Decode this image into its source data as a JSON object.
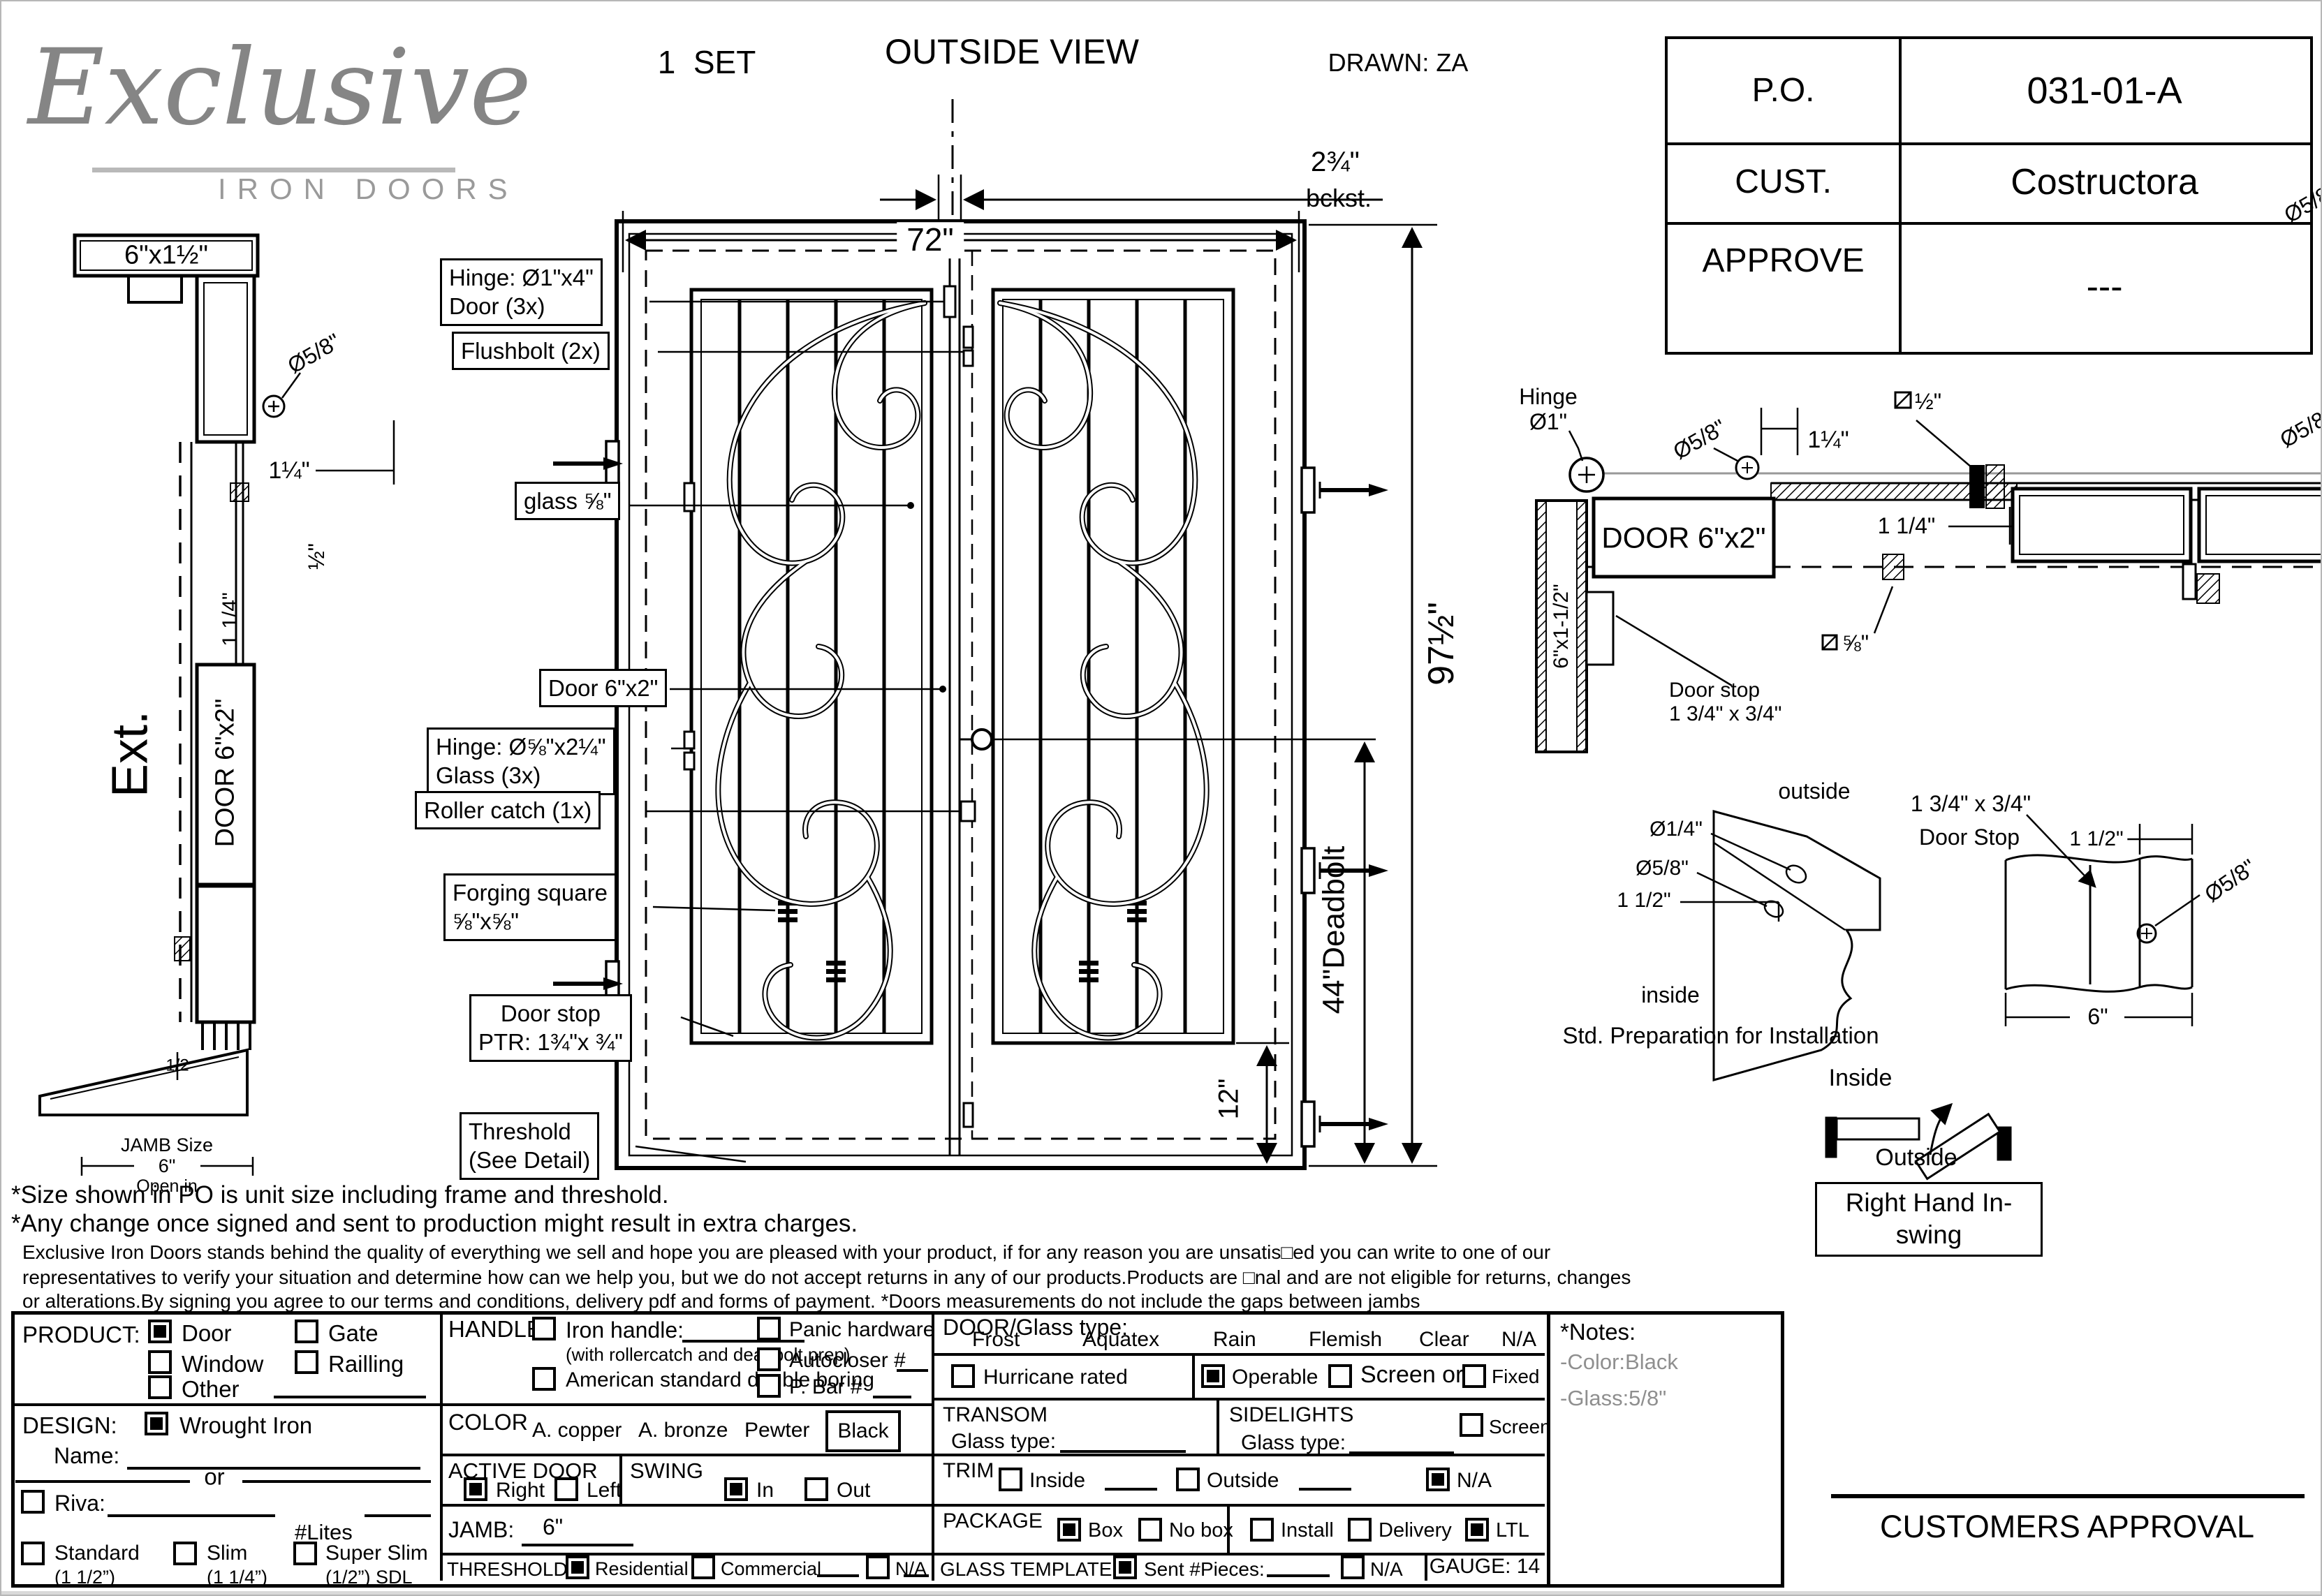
{
  "logo": {
    "script": "Exclusive",
    "sub": "IRON DOORS"
  },
  "header": {
    "set": "1  SET",
    "view": "OUTSIDE VIEW",
    "drawn": "DRAWN: ZA"
  },
  "po": {
    "rows": [
      {
        "label": "P.O.",
        "value": "031-01-A"
      },
      {
        "label": "CUST.",
        "value": "Costructora"
      },
      {
        "label": "APPROVE",
        "value": "---"
      }
    ]
  },
  "side": {
    "cap": "6\"x1½\"",
    "dia58": "Ø5/8\"",
    "dim114": "1¼\"",
    "dim114rot": "1 1/4\"",
    "sq12": "½\"",
    "door": "DOOR 6\"x2\"",
    "ext": "Ext.",
    "half": "1/2",
    "jamb_size": "JAMB Size",
    "jamb_val": "6\"",
    "open_in": "Open in"
  },
  "elev": {
    "dim72": "72\"",
    "bckst_num": "2¾\"",
    "bckst_lbl": "bckst.",
    "h97": "97½\"",
    "deadbolt": "44\"Deadbolt",
    "d12": "12\"",
    "callouts": [
      {
        "l1": "Hinge: Ø1\"x4\"",
        "l2": "Door (3x)"
      },
      {
        "l1": "Flushbolt (2x)"
      },
      {
        "l1": "glass ⅝\""
      },
      {
        "l1": "Door  6\"x2\""
      },
      {
        "l1": "Hinge: Ø⅝\"x2¼\"",
        "l2": "Glass (3x)"
      },
      {
        "l1": "Roller catch  (1x)"
      },
      {
        "l1": "Forging square",
        "l2": "⅝\"x⅝\""
      },
      {
        "l1": "Door stop",
        "l2": "PTR: 1¾\"x ¾\""
      },
      {
        "l1": "Threshold",
        "l2": "(See Detail)"
      }
    ]
  },
  "plan": {
    "hinge1": "Hinge",
    "hinge2": "Ø1\"",
    "dia58": "Ø5/8\"",
    "dim114": "1¼\"",
    "sq12": "½\"",
    "door": "DOOR 6\"x2\"",
    "jamb": "6\"x1-1/2\"",
    "stop1": "Door stop",
    "stop2": "1 3/4\" x 3/4\"",
    "dim114b": "1 1/4\"",
    "sq58": "⅝\"",
    "dia58edge": "Ø5/8"
  },
  "prep": {
    "d14": "Ø1/4\"",
    "d58": "Ø5/8\"",
    "d112": "1 1/2\"",
    "outside": "outside",
    "inside": "inside",
    "caption": "Std. Preparation for Installation"
  },
  "stopd": {
    "l1": "1 3/4\" x 3/4\"",
    "l2": "Door Stop",
    "d112": "1 1/2\"",
    "d58": "Ø5/8\"",
    "d6": "6\""
  },
  "swing": {
    "inside": "Inside",
    "outside": "Outside",
    "label": "Right Hand In-swing"
  },
  "notes": {
    "b1": "*Size shown in PO is unit size including frame and threshold.",
    "b2": "*Any change once signed and sent to production might result in extra charges.",
    "s1": "Exclusive Iron Doors stands behind the quality of everything we sell and hope you are pleased with your product, if for any reason you are unsatis□ed you can write to one of our",
    "s2": "representatives to verify your situation and determine how can we help you, but we do not accept returns in any of our products.Products are □nal and are not eligible for returns, changes",
    "s3": "or alterations.By signing you agree to our terms and conditions, delivery pdf and forms of payment. *Doors measurements do not include the gaps between jambs"
  },
  "form": {
    "product": {
      "label": "PRODUCT:",
      "door": "Door",
      "gate": "Gate",
      "window": "Window",
      "railling": "Railling",
      "other": "Other"
    },
    "design": {
      "label": "DESIGN:",
      "wrought": "Wrought Iron",
      "name": "Name:",
      "or": "or",
      "riva": "Riva:",
      "lites": "#Lites",
      "standard": "Standard",
      "standard2": "(1 1/2”)",
      "slim": "Slim",
      "slim2": "(1 1/4”)",
      "sslim": "Super Slim",
      "sslim2": "(1/2”) SDL"
    },
    "handle": {
      "label": "HANDLE",
      "iron": "Iron handle:",
      "iron2": "(with rollercatch and deadbolt prep)",
      "amer": "American standard double boring",
      "other": "Other:",
      "panic": "Panic hardware",
      "auto": "Autocloser #",
      "pbar": "P. Bar #"
    },
    "color": {
      "label": "COLOR",
      "c1": "A. copper",
      "c2": "A. bronze",
      "c3": "Pewter",
      "c4": "Black"
    },
    "active": {
      "label": "ACTIVE DOOR",
      "right": "Right",
      "left": "Left"
    },
    "swing": {
      "label": "SWING",
      "in": "In",
      "out": "Out"
    },
    "jamb": {
      "label": "JAMB:",
      "value": "6\""
    },
    "threshold": {
      "label": "THRESHOLD",
      "res": "Residential",
      "com": "Commercial",
      "na": "N/A"
    },
    "doorglass": {
      "label": "DOOR/Glass type:",
      "o1": "Frost",
      "o2": "Aquatex",
      "o3": "Rain",
      "o4": "Flemish",
      "o5": "Clear",
      "o6": "N/A"
    },
    "hurricane": "Hurricane rated",
    "operable": "Operable",
    "screenor": "Screen or",
    "fixed": "Fixed",
    "transom": {
      "label": "TRANSOM",
      "glass": "Glass type:"
    },
    "sidelights": {
      "label": "SIDELIGHTS",
      "glass": "Glass type:",
      "screen": "Screen"
    },
    "trim": {
      "label": "TRIM",
      "inside": "Inside",
      "outside": "Outside",
      "na": "N/A"
    },
    "package": {
      "label": "PACKAGE",
      "box": "Box",
      "nobox": "No box",
      "install": "Install",
      "delivery": "Delivery",
      "ltl": "LTL"
    },
    "template": {
      "label": "GLASS TEMPLATE",
      "sent": "Sent #Pieces:",
      "na": "N/A"
    },
    "gauge": "GAUGE: 14",
    "checks": {
      "door": true,
      "gate": false,
      "window": false,
      "railling": false,
      "other": false,
      "wrought": true,
      "riva": false,
      "standard": false,
      "slim": false,
      "sslim": false,
      "iron": false,
      "amer": false,
      "hother": false,
      "panic": false,
      "auto": false,
      "pbar": false,
      "right": true,
      "left": false,
      "in": true,
      "out": false,
      "res": true,
      "com": false,
      "tna": false,
      "hurricane": false,
      "operable": true,
      "screen": false,
      "fixed": false,
      "sscreen": false,
      "tin": false,
      "tout": false,
      "trimna": true,
      "box": true,
      "nobox": false,
      "install": false,
      "delivery": false,
      "ltl": true,
      "sent": true,
      "gna": false
    }
  },
  "sidenotes": {
    "title": "*Notes:",
    "c": "-Color:Black",
    "g": "-Glass:5/8\""
  },
  "approval": "CUSTOMERS APPROVAL"
}
